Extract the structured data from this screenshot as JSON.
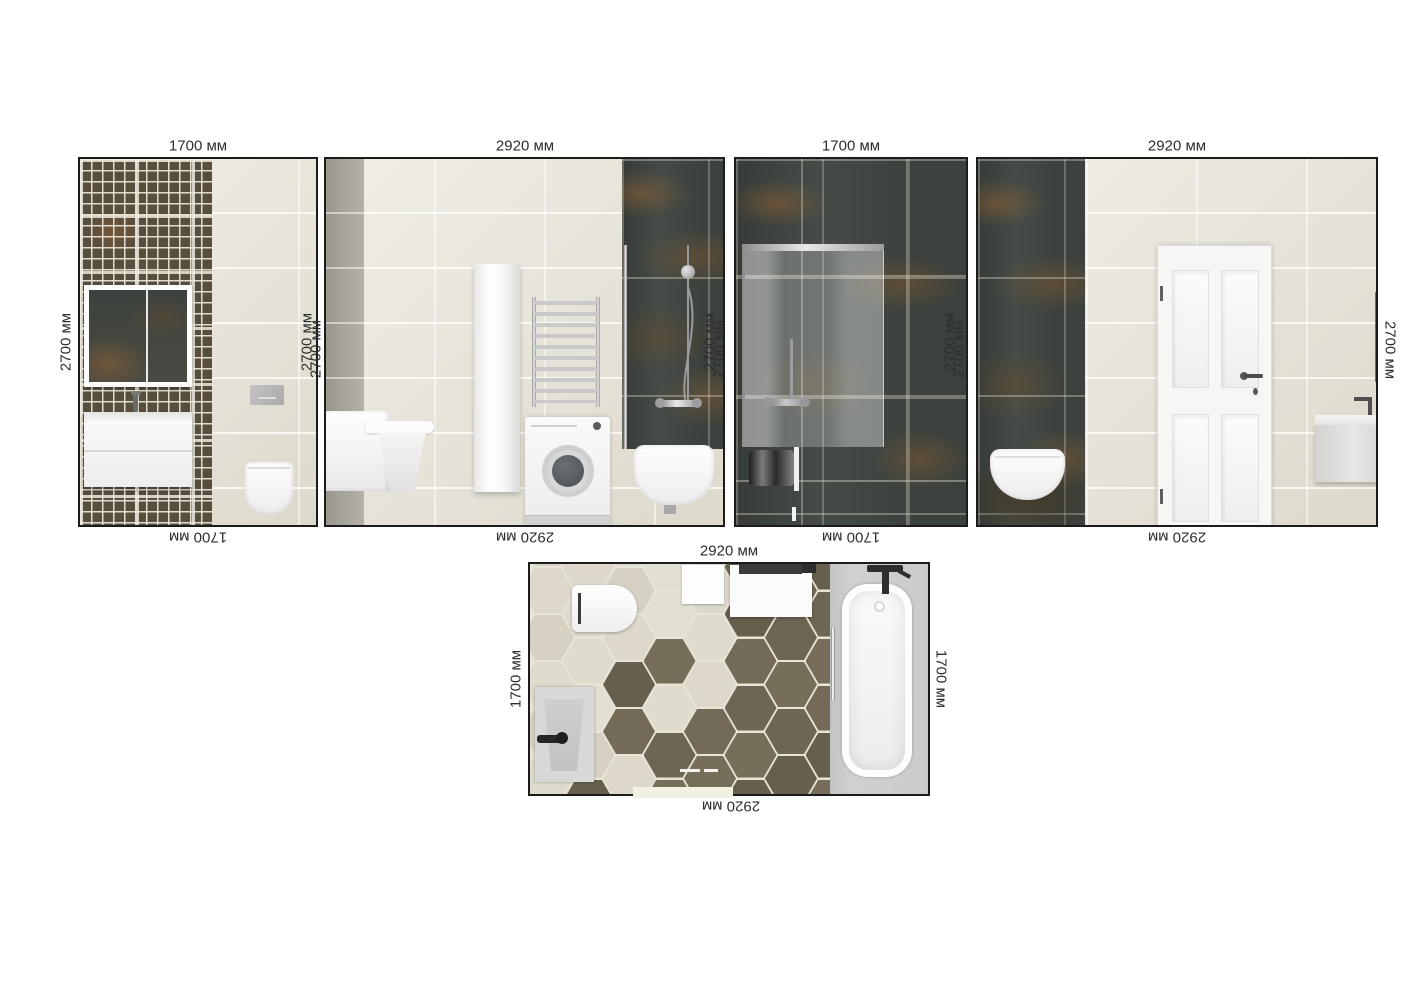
{
  "sheet": {
    "description_labels_unit": "мм",
    "dims": {
      "w1_top": "1700 мм",
      "w2_top": "2920 мм",
      "w3_top": "1700 мм",
      "w4_top": "2920 мм",
      "w1_bottom": "1700 мм",
      "w2_bottom": "2920 мм",
      "w3_bottom": "1700 мм",
      "w4_bottom": "2920 мм",
      "w1_left": "2700 мм",
      "gap12": [
        "2700 мм",
        "2700 мм"
      ],
      "gap23": [
        "2700 мм",
        "2700 мм"
      ],
      "gap34": [
        "2700 мм",
        "2700 мм"
      ],
      "w4_right": "2700 мм",
      "floor_top": "2920 мм",
      "floor_bottom": "2920 мм",
      "floor_left": "1700 мм",
      "floor_right": "1700 мм"
    }
  },
  "colors": {
    "beige_tile": "#eae6db",
    "gray_strip": "#b5b1a7",
    "mosaic_base": "#574e3d",
    "mosaic_grout": "#ece8dc",
    "dark_tile": "#454c47",
    "dark_tile_rust": "#8a5c2e",
    "floor_hex_light": "#ddd8ca",
    "floor_hex_dark": "#6e6654",
    "floor_grout": "#e8e4d7",
    "gray_floor": "#cbcbcb",
    "fixture_white": "#f6f6f6",
    "chrome": "#b0b0b0",
    "label_text": "#2e2e2e"
  }
}
